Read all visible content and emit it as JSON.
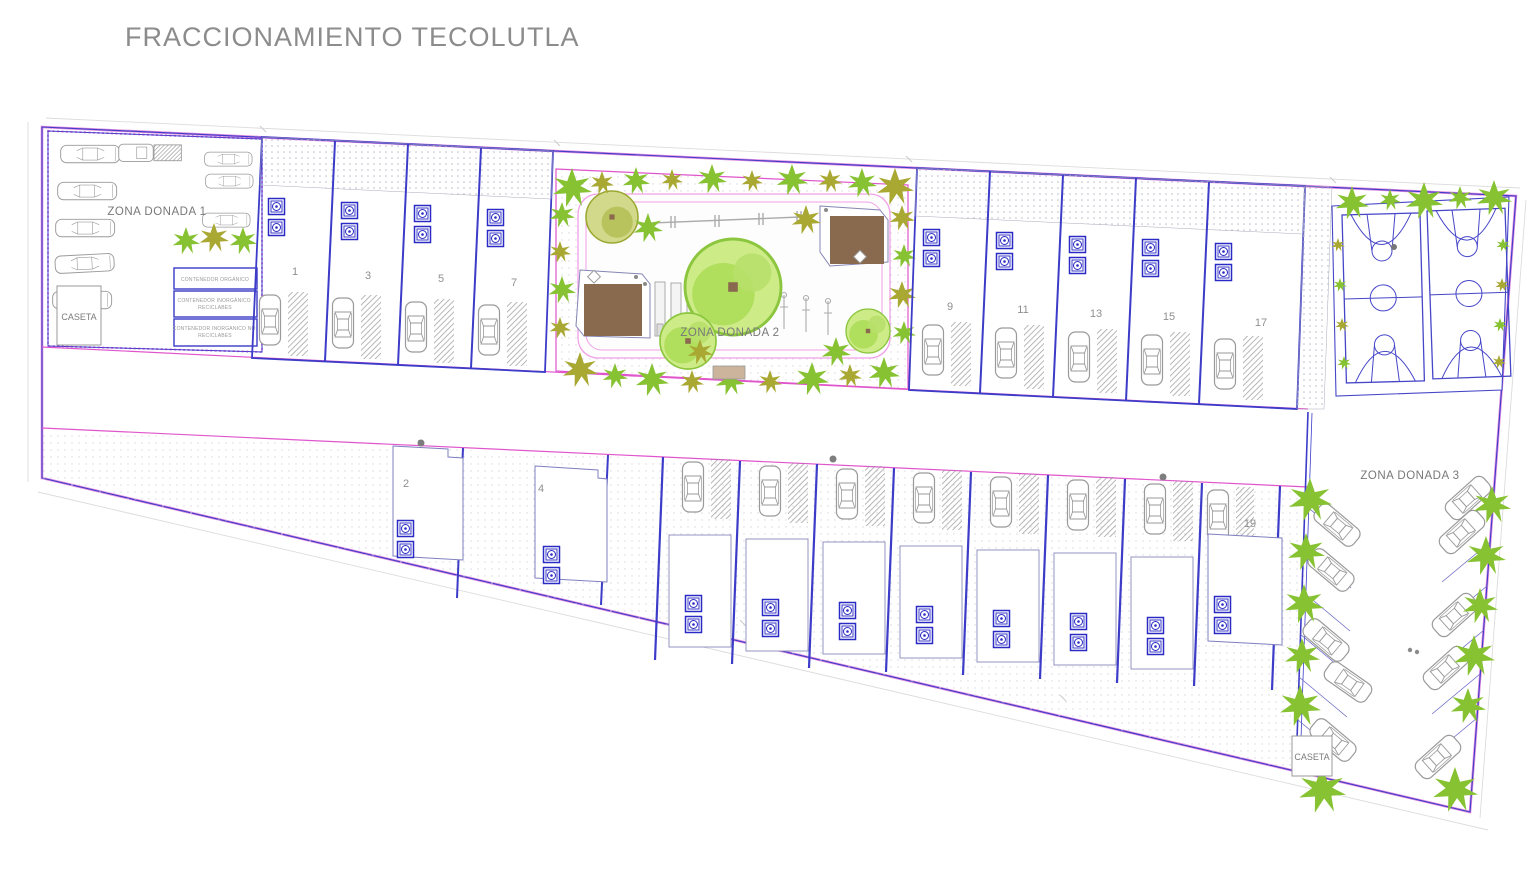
{
  "title": "FRACCIONAMIENTO TECOLUTLA",
  "zones": {
    "donada1": "ZONA DONADA 1",
    "donada2": "ZONA DONADA 2",
    "donada3": "ZONA DONADA 3"
  },
  "guard_booth": {
    "left": "CASETA",
    "right": "CASETA"
  },
  "containers": [
    {
      "line1": "CONTENEDOR ORGÁNICO",
      "line2": ""
    },
    {
      "line1": "CONTENEDOR INORGÁNICO",
      "line2": "RECICLABES"
    },
    {
      "line1": "CONTENEDOR INORGANICO NO",
      "line2": "RECICLABES"
    }
  ],
  "lots": {
    "top_row": [
      "1",
      "3",
      "5",
      "7",
      "9",
      "11",
      "13",
      "15",
      "17"
    ],
    "bottom_row": [
      "2",
      "4",
      "19"
    ]
  },
  "colors": {
    "boundary_blue": "#3c3cc8",
    "boundary_magenta": "#e055cc",
    "path_pink": "#f2a0e8",
    "vegetation_green": "#86c232",
    "vegetation_olive": "#a8a832",
    "palapa_brown": "#8a6a4e",
    "car_gray": "#9a9a9a",
    "label_gray": "#7a7a7a",
    "title_gray": "#8c8c8c"
  }
}
